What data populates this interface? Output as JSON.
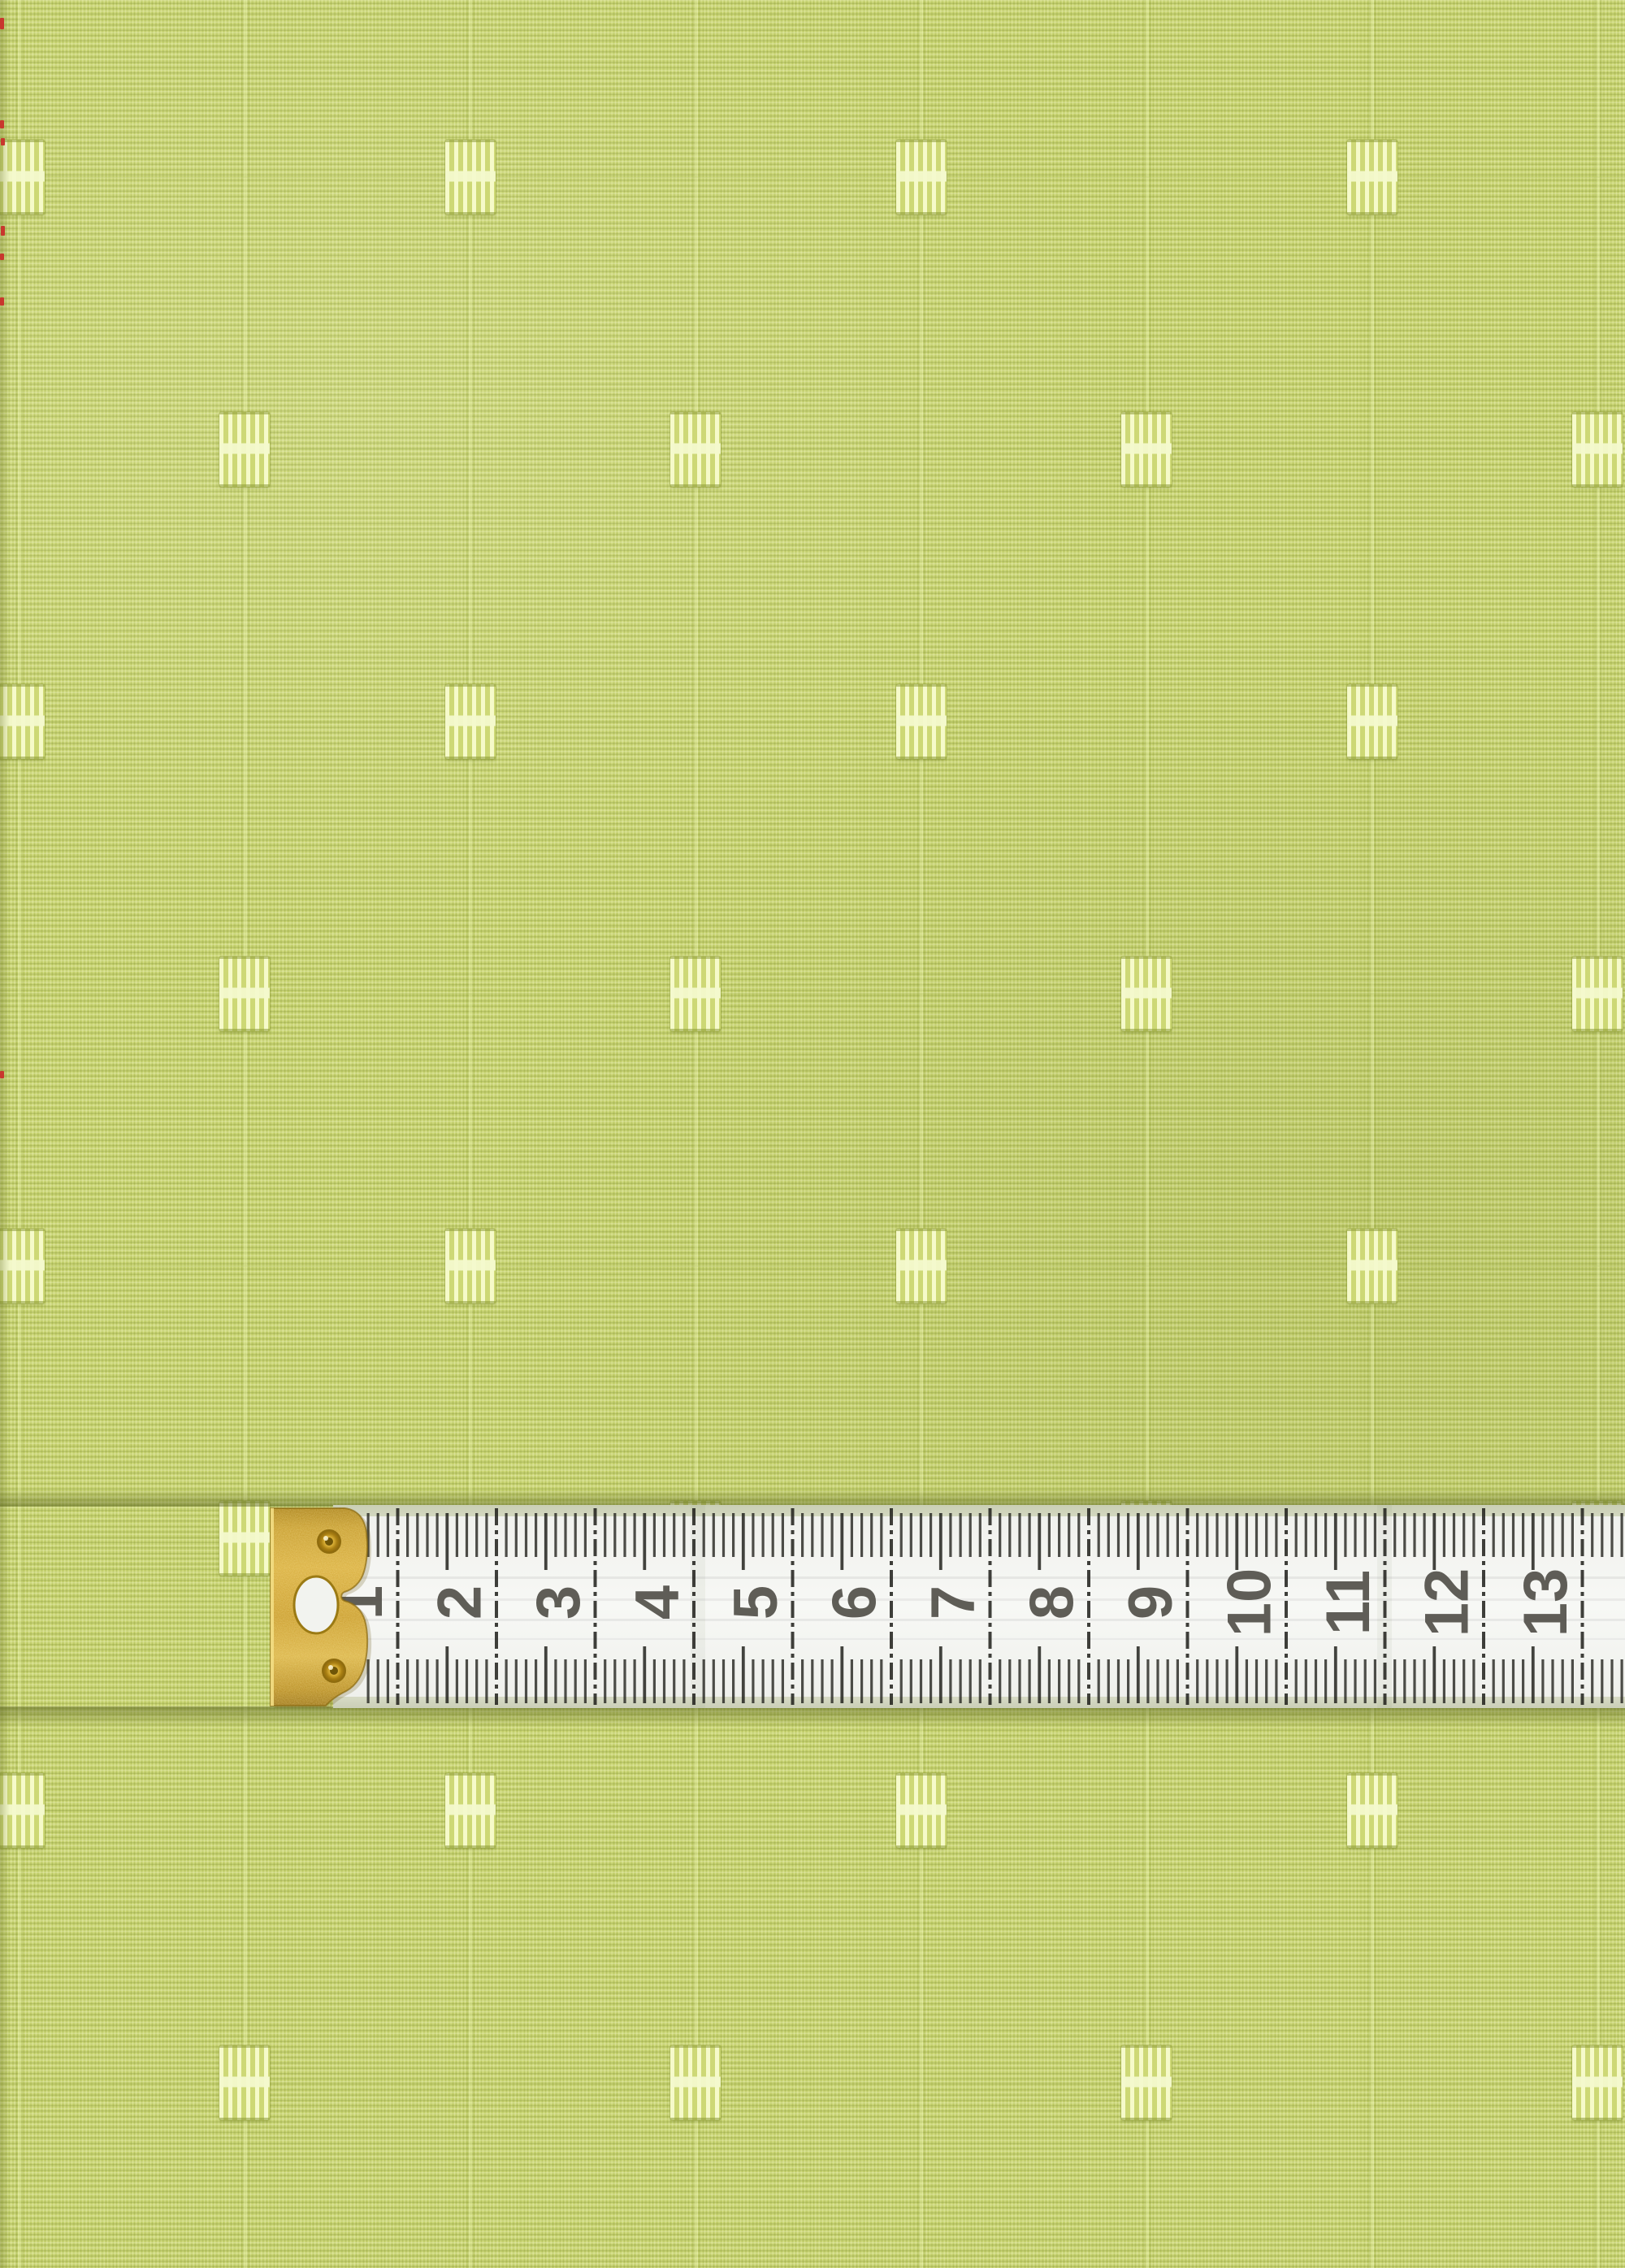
{
  "photo": {
    "subject": "Lime green dobby-dot fabric photographed with a white centimeter measuring tape laid horizontally",
    "fabric": {
      "base_color": "#c7d36f",
      "weave_light_color": "#eaf0b0",
      "weave_dark_color": "#9fae4a",
      "motif_color": "#e9efb4",
      "pinstripe_color": "#e6edaa"
    },
    "tape": {
      "numbers": [
        "1",
        "2",
        "3",
        "4",
        "5",
        "6",
        "7",
        "8",
        "9",
        "10",
        "11",
        "12",
        "13"
      ],
      "body_color": "#f4f5f1",
      "tick_color": "#23231e",
      "number_color": "#53514a",
      "metal_tip_color": "#cb9c2c",
      "rivet_color": "#d9ae35",
      "rivet_count": 2
    },
    "edge_artifacts": {
      "color": "#c8372d",
      "location": "left photo edge"
    }
  }
}
